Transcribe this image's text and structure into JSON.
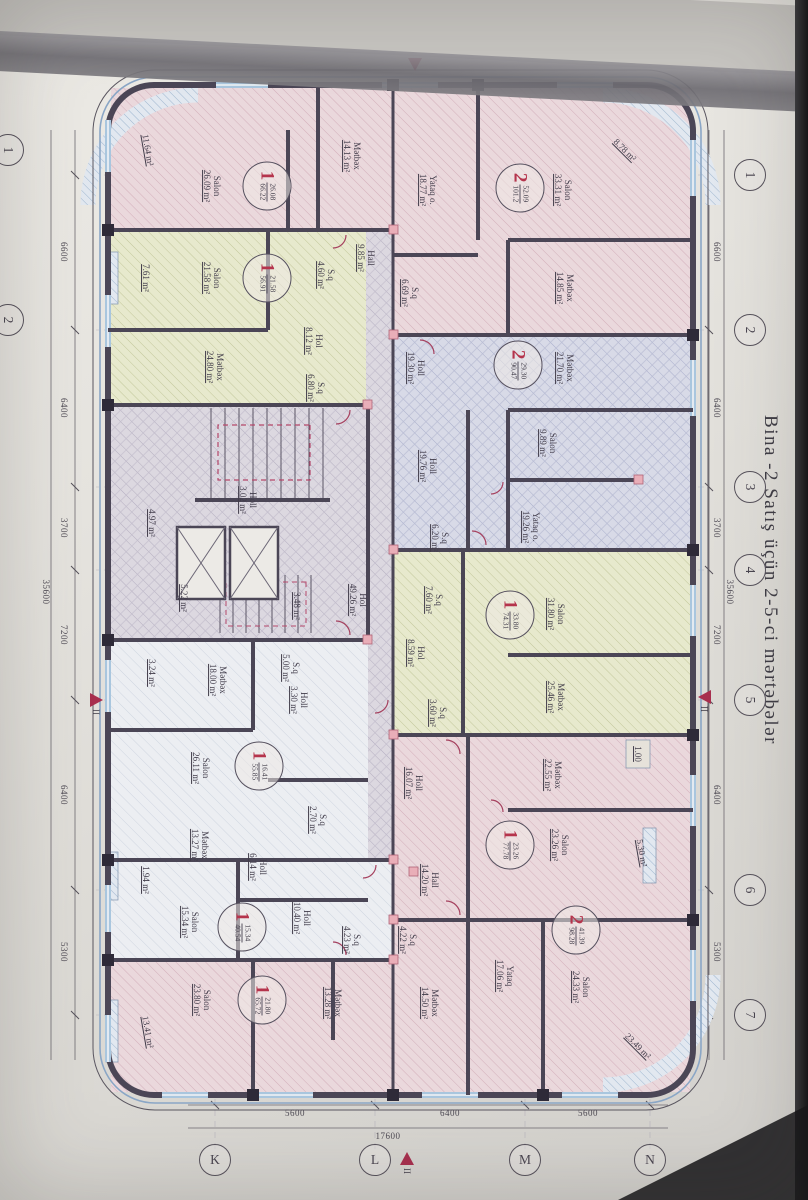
{
  "title": "Bina -2  Satış üçün 2-5-ci mərtəbələr",
  "colors": {
    "paper": "#e8e6e1",
    "wall": "#4b4656",
    "outline_blue": "#8aa6c6",
    "accent_red": "#a82f4e",
    "badge_red": "#b5344c",
    "fill_pink": "#ead8dc",
    "fill_green": "#e7e9cd",
    "fill_purple": "#d6d8e6",
    "fill_common": "#dcd8e0",
    "window_blue": "#a9c6de"
  },
  "grid": {
    "top_bubbles": [
      {
        "label": "1",
        "x": 175
      },
      {
        "label": "2",
        "x": 330
      },
      {
        "label": "3",
        "x": 487
      },
      {
        "label": "4",
        "x": 570
      },
      {
        "label": "5",
        "x": 700
      },
      {
        "label": "6",
        "x": 890
      },
      {
        "label": "7",
        "x": 1015
      }
    ],
    "top_dims": [
      {
        "text": "6600",
        "x": 252
      },
      {
        "text": "6400",
        "x": 408
      },
      {
        "text": "3700",
        "x": 528
      },
      {
        "text": "7200",
        "x": 635
      },
      {
        "text": "6400",
        "x": 795
      },
      {
        "text": "5300",
        "x": 952
      }
    ],
    "top_total": {
      "text": "35600",
      "x": 592,
      "y": 78
    },
    "bottom_dims": [
      {
        "text": "6600",
        "x": 252
      },
      {
        "text": "6400",
        "x": 408
      },
      {
        "text": "3700",
        "x": 528
      },
      {
        "text": "7200",
        "x": 635
      },
      {
        "text": "6400",
        "x": 795
      },
      {
        "text": "5300",
        "x": 952
      }
    ],
    "bottom_total": {
      "text": "35600",
      "x": 592,
      "y": 762
    },
    "clipped_bubbles": [
      {
        "label": "1",
        "x": 150
      },
      {
        "label": "2",
        "x": 320
      }
    ],
    "right_letters": [
      {
        "label": "K",
        "y": 593
      },
      {
        "label": "L",
        "y": 433
      },
      {
        "label": "M",
        "y": 283
      },
      {
        "label": "N",
        "y": 158
      }
    ],
    "right_dims": [
      {
        "text": "5600",
        "y": 513
      },
      {
        "text": "6400",
        "y": 358
      },
      {
        "text": "5600",
        "y": 220
      }
    ],
    "right_total": {
      "text": "17600",
      "y": 420
    },
    "section_markers": [
      {
        "x": 690,
        "y": 97,
        "label": "II",
        "dir": "down"
      },
      {
        "x": 693,
        "y": 705,
        "label": "II",
        "dir": "up"
      },
      {
        "x": 58,
        "y": 386,
        "label": "",
        "dir": "right"
      },
      {
        "x": 1152,
        "y": 394,
        "label": "II",
        "dir": "left"
      }
    ]
  },
  "plan": {
    "rooms": [
      {
        "name": "Salon",
        "area": "33.31 m²",
        "x": 190,
        "y": 245
      },
      {
        "name": "Mətbəx",
        "area": "14.85 m²",
        "x": 288,
        "y": 243
      },
      {
        "name": "Yataq o.",
        "area": "18.77 m²",
        "x": 190,
        "y": 380
      },
      {
        "name": "S.q",
        "area": "6.69 m²",
        "x": 293,
        "y": 398
      },
      {
        "name": "Holl",
        "area": "19.30 m²",
        "x": 368,
        "y": 392
      },
      {
        "name": "",
        "area": "8.78 m²",
        "x": 150,
        "y": 183,
        "rot": -45
      },
      {
        "name": "Mətbəx",
        "area": "21.70 m²",
        "x": 368,
        "y": 243
      },
      {
        "name": "Salon",
        "area": "9.89 m²",
        "x": 443,
        "y": 260
      },
      {
        "name": "Yataq o.",
        "area": "19.26 m²",
        "x": 527,
        "y": 277
      },
      {
        "name": "Holl",
        "area": "19.76 m²",
        "x": 466,
        "y": 380
      },
      {
        "name": "S.q",
        "area": "6.20 m²",
        "x": 538,
        "y": 368
      },
      {
        "name": "Salon",
        "area": "31.80 m²",
        "x": 614,
        "y": 252
      },
      {
        "name": "Mətbəx",
        "area": "25.46 m²",
        "x": 697,
        "y": 252
      },
      {
        "name": "S.q",
        "area": "7.60 m²",
        "x": 600,
        "y": 374
      },
      {
        "name": "Hol",
        "area": "8.59 m²",
        "x": 653,
        "y": 392
      },
      {
        "name": "S.q",
        "area": "3.60 m²",
        "x": 713,
        "y": 370
      },
      {
        "name": "Mətbəx",
        "area": "22.55 m²",
        "x": 775,
        "y": 255
      },
      {
        "name": "Salon",
        "area": "23.26 m²",
        "x": 845,
        "y": 248
      },
      {
        "name": "Holl",
        "area": "16.07 m²",
        "x": 783,
        "y": 394
      },
      {
        "name": "Hall",
        "area": "14.20 m²",
        "x": 880,
        "y": 378
      },
      {
        "name": "",
        "area": "5.30 m²",
        "x": 853,
        "y": 166,
        "rot": -10
      },
      {
        "name": "",
        "area": "1.00",
        "x": 754,
        "y": 170
      },
      {
        "name": "Salon",
        "area": "24.33 m²",
        "x": 987,
        "y": 227
      },
      {
        "name": "Yataq",
        "area": "17.06 m²",
        "x": 976,
        "y": 303
      },
      {
        "name": "Mətbəx",
        "area": "14.50 m²",
        "x": 1003,
        "y": 378
      },
      {
        "name": "S.q",
        "area": "4.22 m²",
        "x": 940,
        "y": 400
      },
      {
        "name": "",
        "area": "23.49 m²",
        "x": 1046,
        "y": 170,
        "rot": -45
      },
      {
        "name": "Salon",
        "area": "26.09 m²",
        "x": 186,
        "y": 596
      },
      {
        "name": "Mətbəx",
        "area": "14.13 m²",
        "x": 156,
        "y": 456
      },
      {
        "name": "Hall",
        "area": "9.85 m²",
        "x": 258,
        "y": 442
      },
      {
        "name": "S.q",
        "area": "4.60 m²",
        "x": 275,
        "y": 482
      },
      {
        "name": "",
        "area": "11.64 m²",
        "x": 150,
        "y": 660,
        "rot": -10
      },
      {
        "name": "",
        "area": "7.61 m²",
        "x": 278,
        "y": 662
      },
      {
        "name": "Salon",
        "area": "21.58 m²",
        "x": 278,
        "y": 596
      },
      {
        "name": "Mətbəx",
        "area": "24.80 m²",
        "x": 367,
        "y": 593
      },
      {
        "name": "Hol",
        "area": "8.12 m²",
        "x": 341,
        "y": 494
      },
      {
        "name": "S.q",
        "area": "6.80 m²",
        "x": 388,
        "y": 492
      },
      {
        "name": "Holl",
        "area": "3.02 m²",
        "x": 500,
        "y": 560
      },
      {
        "name": "",
        "area": "4.97 m²",
        "x": 523,
        "y": 656
      },
      {
        "name": "",
        "area": "5.22 m²",
        "x": 598,
        "y": 624
      },
      {
        "name": "",
        "area": "3.48 m²",
        "x": 606,
        "y": 511
      },
      {
        "name": "Hol",
        "area": "49.26 m²",
        "x": 600,
        "y": 450
      },
      {
        "name": "",
        "area": "3.24 m²",
        "x": 673,
        "y": 656
      },
      {
        "name": "Mətbəx",
        "area": "18.00 m²",
        "x": 680,
        "y": 590
      },
      {
        "name": "S.q",
        "area": "5.00 m²",
        "x": 668,
        "y": 517
      },
      {
        "name": "Holl",
        "area": "3.30 m²",
        "x": 700,
        "y": 509
      },
      {
        "name": "Salon",
        "area": "26.11 m²",
        "x": 768,
        "y": 607
      },
      {
        "name": "Mətbəx",
        "area": "13.27 m²",
        "x": 845,
        "y": 608
      },
      {
        "name": "S.q",
        "area": "2.70 m²",
        "x": 820,
        "y": 490
      },
      {
        "name": "Holl",
        "area": "6.14 m²",
        "x": 867,
        "y": 550
      },
      {
        "name": "Salon",
        "area": "15.34 m²",
        "x": 922,
        "y": 618
      },
      {
        "name": "Holl",
        "area": "10.40 m²",
        "x": 918,
        "y": 506
      },
      {
        "name": "S.q",
        "area": "4.23 m²",
        "x": 940,
        "y": 456
      },
      {
        "name": "Salon",
        "area": "23.80 m²",
        "x": 1000,
        "y": 606
      },
      {
        "name": "Mətbəx",
        "area": "13.28 m²",
        "x": 1003,
        "y": 475
      },
      {
        "name": "",
        "area": "1.94 m²",
        "x": 880,
        "y": 662
      },
      {
        "name": "",
        "area": "13.41 m²",
        "x": 1032,
        "y": 660,
        "rot": -10
      }
    ],
    "badges": [
      {
        "count": "2",
        "top": "52.09",
        "bottom": "101.2",
        "x": 188,
        "y": 288
      },
      {
        "count": "2",
        "top": "29.30",
        "bottom": "90.47",
        "x": 365,
        "y": 290
      },
      {
        "count": "1",
        "top": "33.80",
        "bottom": "74.31",
        "x": 615,
        "y": 298
      },
      {
        "count": "1",
        "top": "23.26",
        "bottom": "77.78",
        "x": 845,
        "y": 298
      },
      {
        "count": "2",
        "top": "41.39",
        "bottom": "98.28",
        "x": 930,
        "y": 232
      },
      {
        "count": "1",
        "top": "26.08",
        "bottom": "66.22",
        "x": 186,
        "y": 541
      },
      {
        "count": "1",
        "top": "21.58",
        "bottom": "56.91",
        "x": 278,
        "y": 541
      },
      {
        "count": "1",
        "top": "16.41",
        "bottom": "55.85",
        "x": 766,
        "y": 549
      },
      {
        "count": "1",
        "top": "15.34",
        "bottom": "40.54",
        "x": 927,
        "y": 566
      },
      {
        "count": "1",
        "top": "21.80",
        "bottom": "65.72",
        "x": 1000,
        "y": 546
      }
    ]
  }
}
